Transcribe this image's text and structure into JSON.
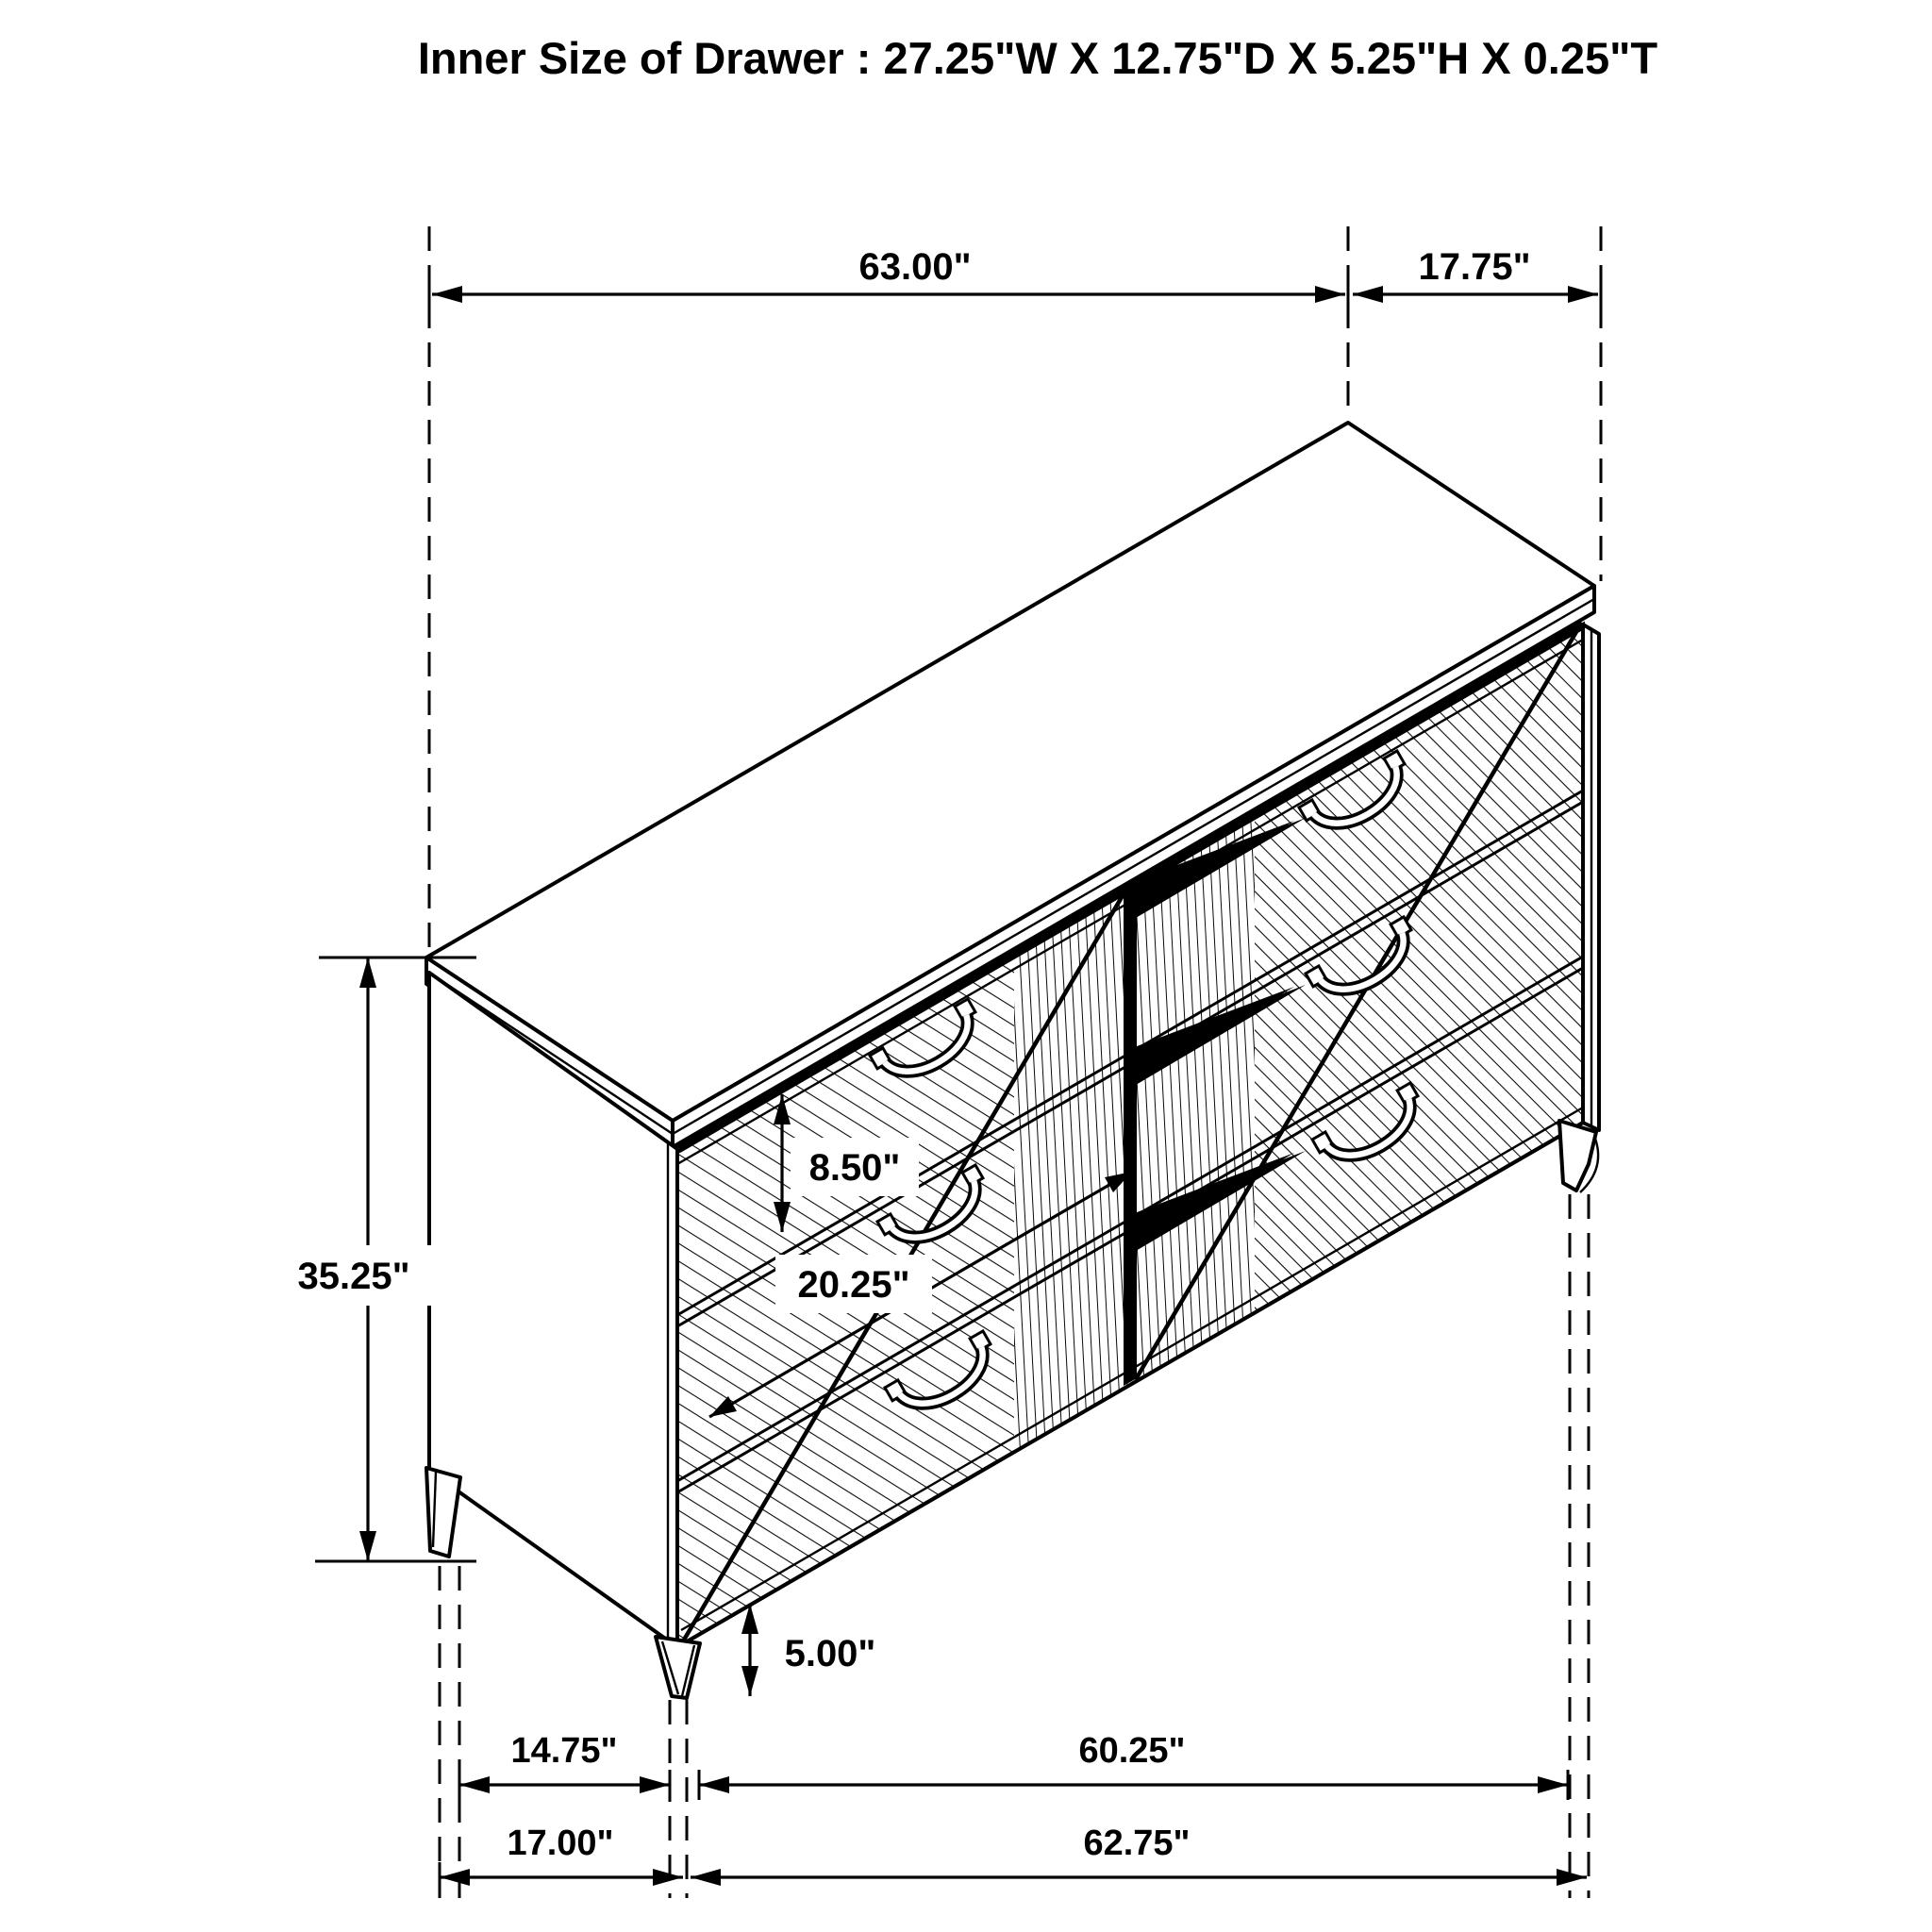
{
  "title": "Inner Size of Drawer : 27.25\"W X 12.75\"D X 5.25\"H X 0.25\"T",
  "drawing": {
    "type": "isometric-furniture-dimension-diagram",
    "subject": "six-drawer dresser",
    "line_color": "#000000",
    "background_color": "#ffffff"
  },
  "dimensions": {
    "top_width": "63.00\"",
    "top_depth": "17.75\"",
    "overall_height": "35.25\"",
    "drawer_front_height": "8.50\"",
    "drawer_width": "20.25\"",
    "leg_height": "5.00\"",
    "side_leg_spacing": "14.75\"",
    "base_depth": "17.00\"",
    "front_leg_spacing": "60.25\"",
    "base_width": "62.75\""
  }
}
